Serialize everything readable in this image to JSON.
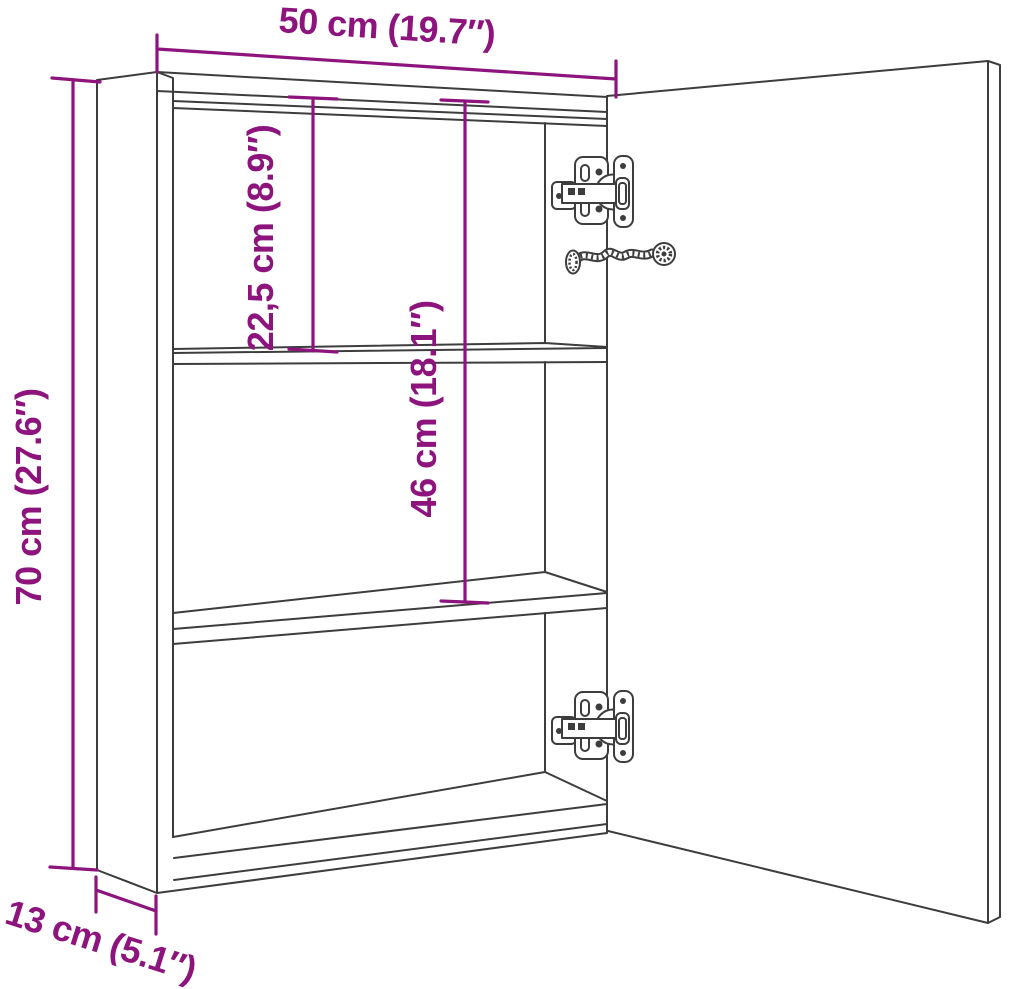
{
  "page": {
    "background": "#ffffff",
    "canvas_width": "1020",
    "canvas_height": "989"
  },
  "drawing": {
    "style": {
      "line_color": "#3d3d3d",
      "dimension_color": "#8e147d"
    },
    "dimensions": [
      {
        "id": "width",
        "label": "50 cm (19.7″)",
        "value_cm": "50",
        "value_in": "19.7"
      },
      {
        "id": "height",
        "label": "70 cm (27.6″)",
        "value_cm": "70",
        "value_in": "27.6"
      },
      {
        "id": "upper-shelf-space",
        "label": "22,5 cm (8.9″)",
        "value_cm": "22,5",
        "value_in": "8.9"
      },
      {
        "id": "shelf-opening",
        "label": "46 cm (18.1″)",
        "value_cm": "46",
        "value_in": "18.1"
      },
      {
        "id": "depth",
        "label": "13 cm (5.1″)",
        "value_cm": "13",
        "value_in": "5.1"
      }
    ]
  }
}
